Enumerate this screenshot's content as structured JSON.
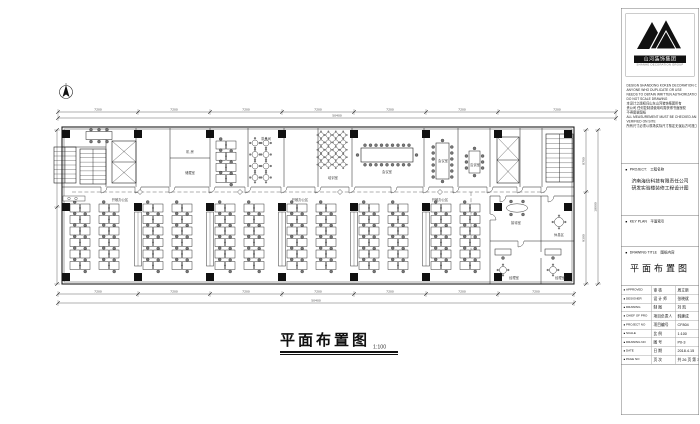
{
  "plan": {
    "title": "平面布置图",
    "title_scale": "1:100",
    "building": {
      "x": 62,
      "y": 127,
      "w": 512,
      "h": 157
    },
    "grid_x": [
      66,
      138,
      210,
      282,
      354,
      426,
      498,
      568
    ],
    "grid_y": [
      134,
      207,
      277
    ],
    "clusters_bottom_x": [
      70,
      99,
      143,
      172,
      215,
      244,
      287,
      316,
      359,
      388,
      431,
      460
    ],
    "cabinet_x": [
      138,
      210,
      282,
      354,
      426
    ],
    "dims": {
      "top": [
        "7200",
        "7200",
        "7200",
        "7200",
        "7200",
        "7200",
        "7200"
      ],
      "top_total": "50400",
      "bottom": [
        "7200",
        "7200",
        "7200",
        "7200",
        "7200",
        "7200",
        "7200"
      ],
      "bottom_total": "50400",
      "right": [
        "8700",
        "9300"
      ],
      "right_total": "18000"
    },
    "room_labels": [
      {
        "text": "机 房",
        "x": 190,
        "y": 153
      },
      {
        "text": "储藏室",
        "x": 190,
        "y": 174
      },
      {
        "text": "茶水间",
        "x": 266,
        "y": 140
      },
      {
        "text": "培训室",
        "x": 333,
        "y": 179
      },
      {
        "text": "会议室",
        "x": 387,
        "y": 173
      },
      {
        "text": "会议室",
        "x": 443,
        "y": 162
      },
      {
        "text": "洽谈室",
        "x": 475,
        "y": 166
      },
      {
        "text": "接待室",
        "x": 516,
        "y": 224
      },
      {
        "text": "休息区",
        "x": 559,
        "y": 236
      },
      {
        "text": "经理室",
        "x": 514,
        "y": 279
      },
      {
        "text": "经理室",
        "x": 560,
        "y": 279
      },
      {
        "text": "开敞办公区",
        "x": 120,
        "y": 201
      },
      {
        "text": "开敞办公区",
        "x": 300,
        "y": 201
      },
      {
        "text": "开敞办公区",
        "x": 440,
        "y": 201
      }
    ]
  },
  "titleblock": {
    "logo_text": "山河装饰集团",
    "logo_sub": "SHANHE DECORATION GROUP",
    "notes": [
      "DESIGN SHANDONG KOKEN DECORATION CO.,",
      "ANYONE WHO DUPLICATE OR USE",
      "NEEDS TO OBTAIN WRITTEN AUTHORIZATION",
      "DO NOT SCALE DRAWING",
      "本设计之版权归山东山河装饰集团所有",
      "贵公司 任何复制或使用均需获得书面授权",
      "不得度量图纸",
      "ALL MEASUREMENT MUST BE CHECKED AND",
      "VERIFIED ON SITE",
      "所有尺寸必须以现场实际尺寸核定无误后方可施工"
    ],
    "project_en": "PROJECT:",
    "project_zh": "工程名称",
    "project_line1": "济南海信科技有限责任公司",
    "project_line2": "研发实验楼装修工程设计图",
    "keyplan_en": "KEY PLAN",
    "keyplan_zh": "平面索引",
    "drawing_en": "DRAWING TITLE",
    "drawing_zh": "图纸内容",
    "drawing_value": "平面布置图",
    "table_rows": [
      {
        "en": "APPROVED",
        "zh": "审 核",
        "val": "周立新"
      },
      {
        "en": "DESIGNER",
        "zh": "设 计 师",
        "val": "张晓斌"
      },
      {
        "en": "DRAWING",
        "zh": "制 图",
        "val": "刘 凯"
      },
      {
        "en": "CHIEF OF PRO",
        "zh": "项目负责人",
        "val": "韩建成"
      },
      {
        "en": "PROJECT NO",
        "zh": "项目编号",
        "val": "CF804"
      },
      {
        "en": "SCALE",
        "zh": "比 例",
        "val": "1:100"
      },
      {
        "en": "DRAWING NO",
        "zh": "图 号",
        "val": "P0-3"
      },
      {
        "en": "DATE",
        "zh": "日 期",
        "val": "2018.4.15"
      },
      {
        "en": "PAGE NO",
        "zh": "页 次",
        "val": "共 26 页 第 3 页"
      }
    ]
  }
}
